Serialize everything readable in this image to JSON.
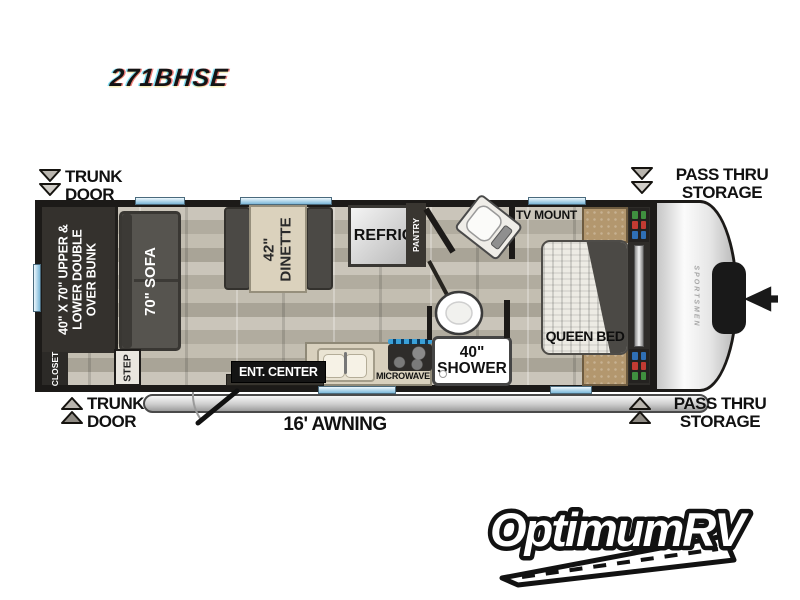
{
  "model_number": "271BHSE",
  "brand_cap": "SPORTSMEN",
  "callouts": {
    "trunk_top_1": "TRUNK",
    "trunk_top_2": "DOOR",
    "trunk_bottom_1": "TRUNK",
    "trunk_bottom_2": "DOOR",
    "pass_top_1": "PASS THRU",
    "pass_top_2": "STORAGE",
    "pass_bottom_1": "PASS THRU",
    "pass_bottom_2": "STORAGE",
    "awning": "16' AWNING"
  },
  "features": {
    "bunk_1": "40\" X 70\" UPPER &",
    "bunk_2": "LOWER DOUBLE",
    "bunk_3": "OVER BUNK",
    "sofa": "70\" SOFA",
    "dinette_1": "42\"",
    "dinette_2": "DINETTE",
    "refrig": "REFRIG",
    "pantry": "PANTRY",
    "tv_mount": "TV MOUNT",
    "queen_bed": "QUEEN BED",
    "closet": "CLOSET",
    "step": "STEP",
    "ent_center": "ENT. CENTER",
    "microwave": "MICROWAVE",
    "shower_1": "40\"",
    "shower_2": "SHOWER"
  },
  "dealer_logo": "OptimumRV",
  "colors": {
    "wall": "#1c1a18",
    "floor_base": "#bcb7ac",
    "furniture_dark": "#4a4846",
    "window_blue": "#7cb8d9",
    "table_tan": "#dbd2bd",
    "nightstand_brown": "#b3976e",
    "storage_red": "#c23b32",
    "storage_blue": "#2f6fb4",
    "storage_green": "#3f8f3f"
  }
}
